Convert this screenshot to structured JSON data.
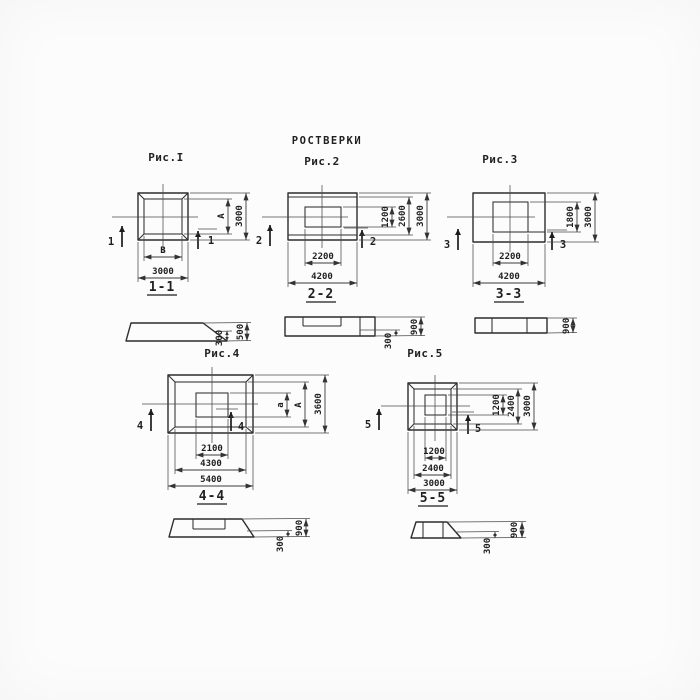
{
  "title": "РОСТВЕРКИ",
  "figures": {
    "fig1": {
      "label": "Рис.I",
      "cut_number": "1",
      "section_label": "1-1",
      "plan_dims": {
        "inner_width": "В",
        "outer_width": "3000",
        "inner_height": "А",
        "outer_height": "3000"
      },
      "section_dims": {
        "total_height": "500",
        "edge_height": "300"
      }
    },
    "fig2": {
      "label": "Рис.2",
      "cut_number": "2",
      "section_label": "2-2",
      "plan_dims": {
        "inner_width": "2200",
        "outer_width": "4200",
        "inner_height": "1200",
        "mid_height": "2600",
        "outer_height": "3000"
      },
      "section_dims": {
        "total_height": "900",
        "edge_height": "300"
      }
    },
    "fig3": {
      "label": "Рис.3",
      "cut_number": "3",
      "section_label": "3-3",
      "plan_dims": {
        "inner_width": "2200",
        "outer_width": "4200",
        "inner_height": "1800",
        "outer_height": "3000"
      },
      "section_dims": {
        "total_height": "900"
      }
    },
    "fig4": {
      "label": "Рис.4",
      "cut_number": "4",
      "section_label": "4-4",
      "plan_dims": {
        "recess_width": "2100",
        "mid_width": "4300",
        "outer_width": "5400",
        "recess_height": "а",
        "mid_height": "А",
        "outer_height": "3600"
      },
      "section_dims": {
        "total_height": "900",
        "edge_height": "300"
      }
    },
    "fig5": {
      "label": "Рис.5",
      "cut_number": "5",
      "section_label": "5-5",
      "plan_dims": {
        "recess_width": "1200",
        "mid_width": "2400",
        "outer_width": "3000",
        "recess_height": "1200",
        "mid_height": "2400",
        "outer_height": "3000"
      },
      "section_dims": {
        "total_height": "900",
        "edge_height": "300"
      }
    }
  }
}
